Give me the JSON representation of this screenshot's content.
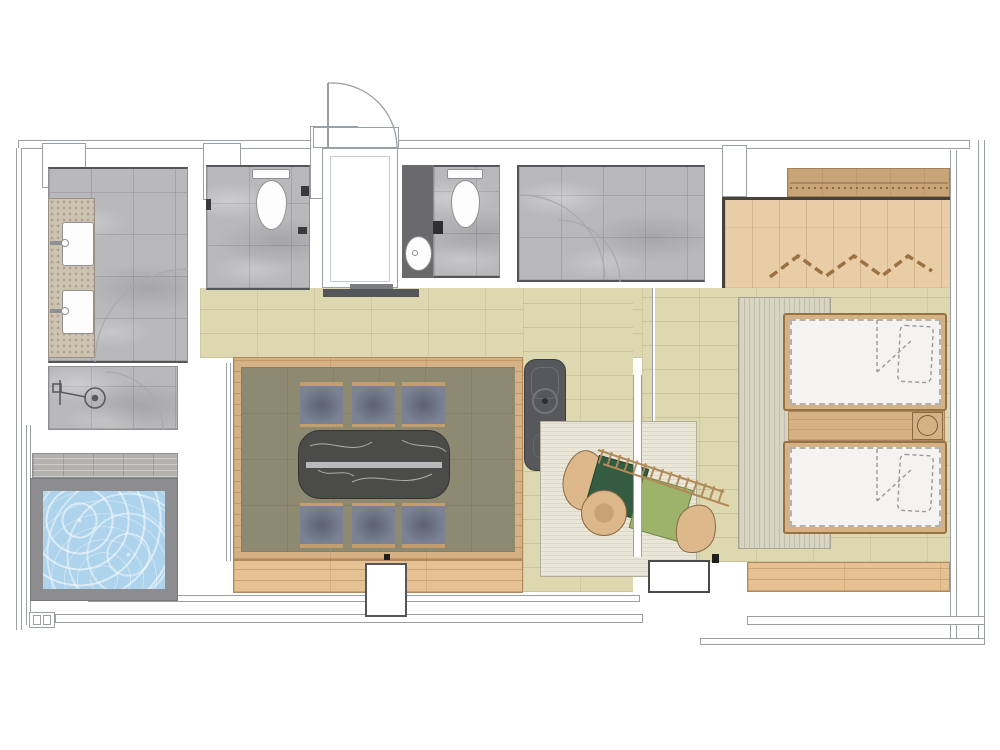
{
  "document": {
    "type": "architectural floor plan",
    "style": "top-down colored rendering, no text labels",
    "text_labels": []
  },
  "palette": {
    "background": "#ffffff",
    "wall_line": "#9aa0a4",
    "wall_dark": "#6a6a6c",
    "tile_gray": "#b9b9bc",
    "granite_counter": "#cdc3b1",
    "beige_floor": "#ded8b1",
    "olive_carpet": "#8e8a72",
    "wood_frame": "#d6b183",
    "wood_light": "#e6c193",
    "wood_bedroom": "#e9cda6",
    "wood_wardrobe": "#c9a478",
    "rug_living": "#eae6d8",
    "rug_bedroom": "#d9d5c3",
    "marble_table": "#4b4b49",
    "table_runner": "#b9babb",
    "chair_seat": "#7b8294",
    "chair_trim": "#c29d6d",
    "water": "#aed3ec",
    "pool_deck": "#8d8d8f",
    "fireplace": "#57585c",
    "cushion_dark_green": "#335c40",
    "cushion_light_green": "#9db36a",
    "tan_furniture": "#dcb88b",
    "mattress": "#f4f3f1",
    "accent_dashes": "#9c7144"
  },
  "rooms": [
    {
      "name": "bathroom",
      "fixtures": [
        "double-vanity",
        "sink",
        "sink",
        "walk-in-shower"
      ]
    },
    {
      "name": "plunge-pool",
      "fixtures": [
        "water-basin",
        "gray-deck"
      ]
    },
    {
      "name": "toilet-room-1",
      "fixtures": [
        "toilet"
      ]
    },
    {
      "name": "entry-hall",
      "fixtures": [
        "entry-door-swing"
      ]
    },
    {
      "name": "toilet-room-2",
      "fixtures": [
        "toilet",
        "oval-washbasin",
        "dark-vanity-wall"
      ]
    },
    {
      "name": "shower-room-2",
      "fixtures": [
        "glass-door-swing"
      ]
    },
    {
      "name": "dining-room",
      "fixtures": [
        "marble-table",
        "table-runner",
        "chair",
        "chair",
        "chair",
        "chair",
        "chair",
        "chair"
      ]
    },
    {
      "name": "living-nook",
      "fixtures": [
        "fireplace",
        "area-rug",
        "slatted-daybed",
        "dark-green-cushion",
        "light-green-cushion",
        "round-pouf"
      ]
    },
    {
      "name": "bedroom",
      "fixtures": [
        "twin-bed",
        "twin-bed",
        "nightstand",
        "lamp",
        "striped-rug",
        "wardrobe-band",
        "zigzag-hanger-rail"
      ]
    },
    {
      "name": "veranda",
      "fixtures": [
        "wood-deck",
        "window-column"
      ]
    }
  ],
  "counts": {
    "chairs": 6,
    "beds": 2,
    "toilets": 2,
    "vanity_sinks": 2,
    "small_basins": 1
  }
}
